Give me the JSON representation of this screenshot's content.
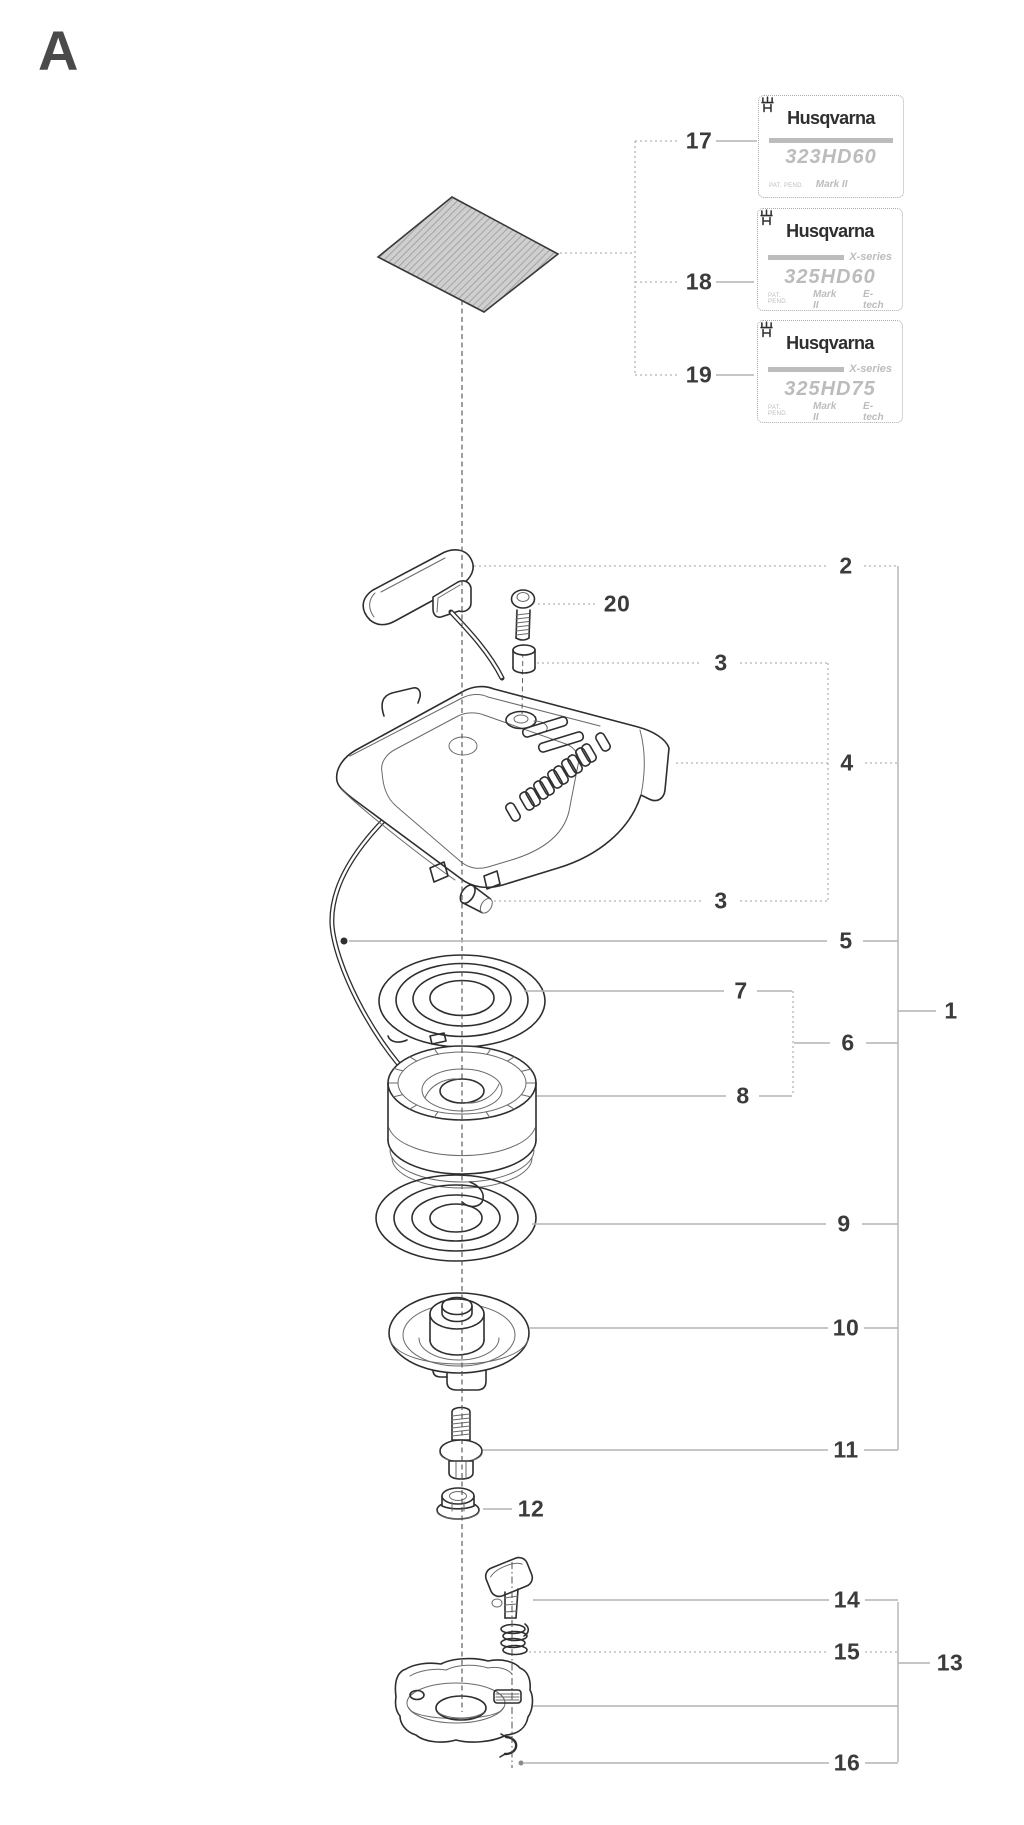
{
  "page": {
    "letter": "A"
  },
  "colors": {
    "line": "#2e2e2e",
    "leader": "#b3b3b3",
    "number": "#3b3b3b",
    "decal_text": "#bcbcbc"
  },
  "labels": [
    {
      "ref": "17",
      "brand": "Husqvarna",
      "series": "",
      "model": "323HD60",
      "pat": "PAT. PEND.",
      "mark": "Mark II",
      "etech": ""
    },
    {
      "ref": "18",
      "brand": "Husqvarna",
      "series": "X-series",
      "model": "325HD60",
      "pat": "PAT. PEND.",
      "mark": "Mark II",
      "etech": "E-tech"
    },
    {
      "ref": "19",
      "brand": "Husqvarna",
      "series": "X-series",
      "model": "325HD75",
      "pat": "PAT. PEND.",
      "mark": "Mark II",
      "etech": "E-tech"
    }
  ],
  "diagram": {
    "callouts": [
      {
        "n": "17",
        "x": 699,
        "y": 141
      },
      {
        "n": "18",
        "x": 699,
        "y": 282
      },
      {
        "n": "19",
        "x": 699,
        "y": 375
      },
      {
        "n": "2",
        "x": 846,
        "y": 566
      },
      {
        "n": "20",
        "x": 617,
        "y": 604
      },
      {
        "n": "3",
        "x": 721,
        "y": 663
      },
      {
        "n": "4",
        "x": 847,
        "y": 763
      },
      {
        "n": "3",
        "x": 721,
        "y": 901
      },
      {
        "n": "5",
        "x": 846,
        "y": 941
      },
      {
        "n": "7",
        "x": 741,
        "y": 991
      },
      {
        "n": "1",
        "x": 951,
        "y": 1011
      },
      {
        "n": "6",
        "x": 848,
        "y": 1043
      },
      {
        "n": "8",
        "x": 743,
        "y": 1096
      },
      {
        "n": "9",
        "x": 844,
        "y": 1224
      },
      {
        "n": "10",
        "x": 846,
        "y": 1328
      },
      {
        "n": "11",
        "x": 846,
        "y": 1450
      },
      {
        "n": "12",
        "x": 531,
        "y": 1509
      },
      {
        "n": "14",
        "x": 847,
        "y": 1600
      },
      {
        "n": "15",
        "x": 847,
        "y": 1652
      },
      {
        "n": "13",
        "x": 950,
        "y": 1663
      },
      {
        "n": "16",
        "x": 847,
        "y": 1763
      }
    ]
  }
}
